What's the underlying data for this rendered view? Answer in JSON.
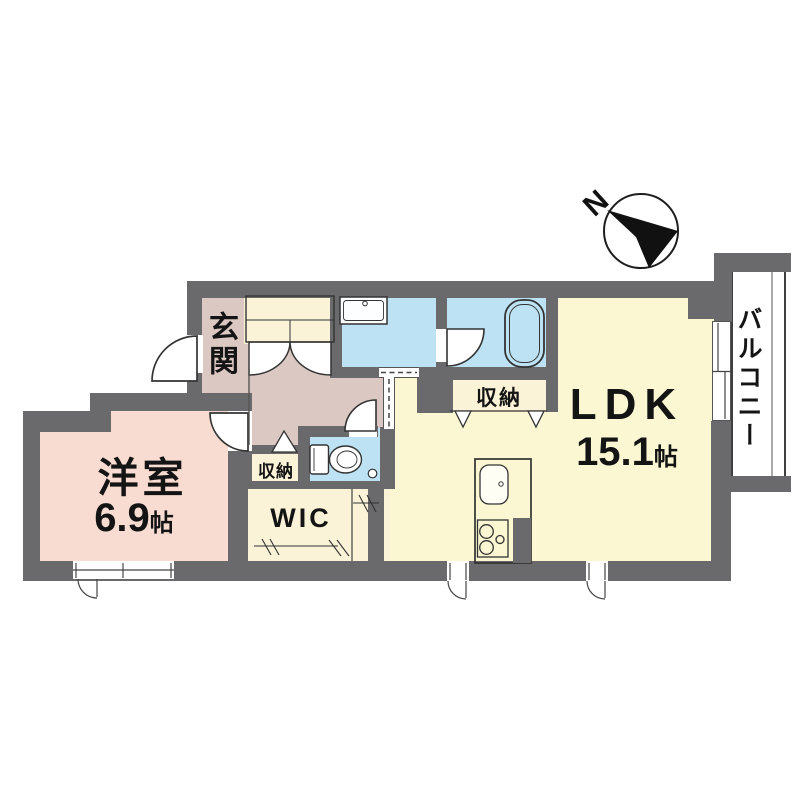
{
  "compass": {
    "label": "N"
  },
  "rooms": {
    "entrance": {
      "label": "玄関"
    },
    "western_room": {
      "label": "洋室",
      "size_value": "6.9",
      "size_unit": "帖"
    },
    "ldk": {
      "label": "LDK",
      "size_value": "15.1",
      "size_unit": "帖"
    },
    "wic": {
      "label": "WIC"
    },
    "hall_storage": {
      "label": "収納"
    },
    "ldk_storage": {
      "label": "収納"
    },
    "balcony": {
      "label": "バルコニー"
    }
  },
  "colors": {
    "wall": "#6a6a6d",
    "ldk_floor": "#faf7d2",
    "bedroom_floor": "#f8dcd1",
    "hall_floor": "#dbc8c2",
    "wet_area_floor": "#bce2f3",
    "closet_floor": "#fbf3d8",
    "line": "#333333"
  }
}
